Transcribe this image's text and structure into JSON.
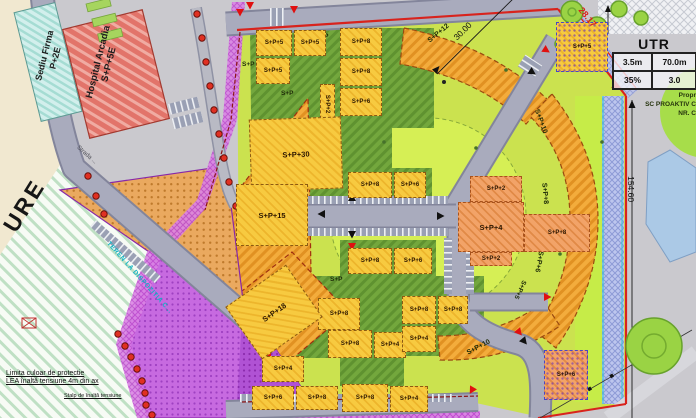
{
  "map": {
    "streets": {
      "street_label": "Strada ..."
    },
    "notes": {
      "partial_left_text": "URE",
      "teren": "TEREN LA DISPOZITIA C...",
      "lea_line1": "Limita culoar de protectie",
      "lea_line2": "LEA înaltă tensiune  4m din ax",
      "stalp": "Stalp de înaltă tensiune"
    },
    "neighbors": {
      "sediu_line1": "Sediu Firma",
      "sediu_line2": "P+2E",
      "hospital_line1": "Hospital Arcadia",
      "hospital_line2": "S+P+5E"
    },
    "dimensions": {
      "north": "30.00",
      "northeast": "28.17",
      "east": "154.60"
    },
    "utr": {
      "title": "UTR",
      "rows": [
        [
          "3.5m",
          "70.0m"
        ],
        [
          "35%",
          "3.0"
        ]
      ]
    },
    "owner_note": {
      "line1": "Propr",
      "line2": "SC PROAKTIV C",
      "line3": "NR. C"
    }
  },
  "buildings": [
    {
      "x": 256,
      "y": 30,
      "w": 36,
      "h": 26,
      "label": "S+P+5"
    },
    {
      "x": 294,
      "y": 30,
      "w": 32,
      "h": 26,
      "label": "S+P+5"
    },
    {
      "x": 340,
      "y": 28,
      "w": 42,
      "h": 28,
      "label": "S+P+8"
    },
    {
      "x": 256,
      "y": 58,
      "w": 34,
      "h": 26,
      "label": "S+P+5"
    },
    {
      "x": 340,
      "y": 58,
      "w": 42,
      "h": 28,
      "label": "S+P+8"
    },
    {
      "x": 340,
      "y": 88,
      "w": 42,
      "h": 28,
      "label": "S+P+6"
    },
    {
      "x": 320,
      "y": 84,
      "w": 15,
      "h": 40,
      "label": "S+P+2",
      "vert": true
    },
    {
      "x": 250,
      "y": 118,
      "w": 92,
      "h": 72,
      "rot": -2,
      "label": "S+P+30",
      "big": true
    },
    {
      "x": 236,
      "y": 184,
      "w": 72,
      "h": 62,
      "label": "S+P+15",
      "big": true
    },
    {
      "x": 348,
      "y": 172,
      "w": 44,
      "h": 26,
      "label": "S+P+8"
    },
    {
      "x": 394,
      "y": 172,
      "w": 32,
      "h": 26,
      "label": "S+P+6"
    },
    {
      "x": 348,
      "y": 248,
      "w": 44,
      "h": 26,
      "label": "S+P+8"
    },
    {
      "x": 394,
      "y": 248,
      "w": 38,
      "h": 26,
      "label": "S+P+6"
    },
    {
      "x": 318,
      "y": 298,
      "w": 42,
      "h": 32,
      "label": "S+P+8"
    },
    {
      "x": 328,
      "y": 330,
      "w": 44,
      "h": 28,
      "label": "S+P+8"
    },
    {
      "x": 374,
      "y": 332,
      "w": 32,
      "h": 26,
      "label": "S+P+4"
    },
    {
      "x": 262,
      "y": 356,
      "w": 42,
      "h": 26,
      "label": "S+P+4"
    },
    {
      "x": 252,
      "y": 386,
      "w": 42,
      "h": 24,
      "label": "S+P+6"
    },
    {
      "x": 296,
      "y": 386,
      "w": 42,
      "h": 24,
      "label": "S+P+8"
    },
    {
      "x": 342,
      "y": 384,
      "w": 46,
      "h": 28,
      "label": "S+P+8"
    },
    {
      "x": 390,
      "y": 386,
      "w": 38,
      "h": 26,
      "label": "S+P+4"
    },
    {
      "x": 402,
      "y": 296,
      "w": 34,
      "h": 28,
      "label": "S+P+8"
    },
    {
      "x": 438,
      "y": 296,
      "w": 30,
      "h": 28,
      "label": "S+P+8"
    },
    {
      "x": 402,
      "y": 326,
      "w": 34,
      "h": 26,
      "label": "S+P+4"
    },
    {
      "x": 237,
      "y": 280,
      "w": 74,
      "h": 64,
      "rot": -35,
      "label": "S+P+18",
      "big": true
    },
    {
      "x": 556,
      "y": 22,
      "w": 52,
      "h": 50,
      "label": "S+P+5",
      "cls": "b-yellow b-dots"
    },
    {
      "x": 470,
      "y": 176,
      "w": 52,
      "h": 26,
      "label": "S+P+2",
      "cls": "b-salmon"
    },
    {
      "x": 458,
      "y": 202,
      "w": 66,
      "h": 50,
      "label": "S+P+4",
      "cls": "b-salmon",
      "big": true
    },
    {
      "x": 470,
      "y": 252,
      "w": 42,
      "h": 14,
      "label": "S+P+2",
      "cls": "b-salmon"
    },
    {
      "x": 524,
      "y": 214,
      "w": 66,
      "h": 38,
      "label": "S+P+8",
      "cls": "b-salmon"
    },
    {
      "x": 544,
      "y": 350,
      "w": 44,
      "h": 50,
      "label": "S+P+6",
      "cls": "b-salmon b-dots"
    }
  ],
  "ground_labels": [
    {
      "x": 316,
      "y": 33,
      "t": "S+P"
    },
    {
      "x": 242,
      "y": 61,
      "t": "S+P"
    },
    {
      "x": 281,
      "y": 90,
      "t": "S+P"
    },
    {
      "x": 330,
      "y": 276,
      "t": "S+P"
    },
    {
      "x": 299,
      "y": 313,
      "t": "S+P"
    },
    {
      "x": 426,
      "y": 30,
      "t": "S+P+12",
      "rot": -40,
      "size": 7
    },
    {
      "x": 528,
      "y": 118,
      "t": "S+P+10",
      "rot": 70,
      "size": 7
    },
    {
      "x": 534,
      "y": 190,
      "t": "S+P+8",
      "rot": 85,
      "size": 7
    },
    {
      "x": 528,
      "y": 258,
      "t": "S+P+6",
      "rot": 100,
      "size": 7
    },
    {
      "x": 466,
      "y": 344,
      "t": "S+P+10",
      "rot": -28,
      "size": 7
    },
    {
      "x": 510,
      "y": 286,
      "t": "S+P+5",
      "rot": 115,
      "size": 6.5
    }
  ],
  "colors": {
    "boundary_red": "#d8231d",
    "parcel_green": "#cbe24f",
    "block_yellow": "#f6c83e",
    "orange_zone": "#f2a93c",
    "dark_green_hatch": "#74a73e",
    "purple_zone": "#c769e0",
    "plaza_orange": "#eaa95f",
    "road_gray": "#a9abbd",
    "lake_blue": "#abc9e6",
    "strip_blue": "#bcc5ee",
    "cyan_accent": "#2ec4d6",
    "tree_green": "#9ad344"
  }
}
